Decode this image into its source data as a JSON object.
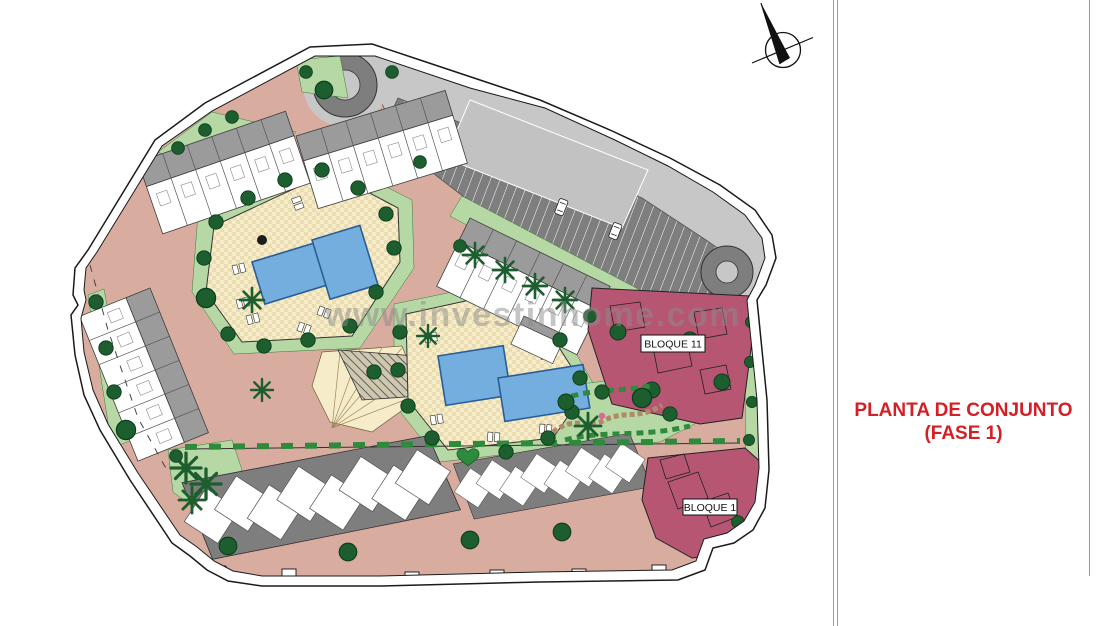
{
  "plan": {
    "watermark": "www.investinhome.com",
    "labels": {
      "bloque11": "BLOQUE 11",
      "bloque1": "BLOQUE 1"
    }
  },
  "panel": {
    "title_line1": "PLANTA DE CONJUNTO",
    "title_line2": "(FASE 1)"
  },
  "icons": {
    "north_arrow": "north-arrow-icon"
  },
  "colors": {
    "road": "#d9aca0",
    "green": "#b5d8a5",
    "green-dark": "#1c5e2d",
    "hedge": "#2f8a3c",
    "parking-dark": "#7e7e7e",
    "parking-light": "#c7c7c7",
    "building-gray": "#9b9b9b",
    "deck-cream": "#f7ecc9",
    "deck-cream-dark": "#eaddb2",
    "pool-blue": "#74aede",
    "pool-blue-dark": "#2a5d97",
    "bloque-maroon": "#b65672",
    "title-red": "#d31f26",
    "watermark-gray": "#8c8c8c",
    "outline": "#1a1a1a"
  }
}
